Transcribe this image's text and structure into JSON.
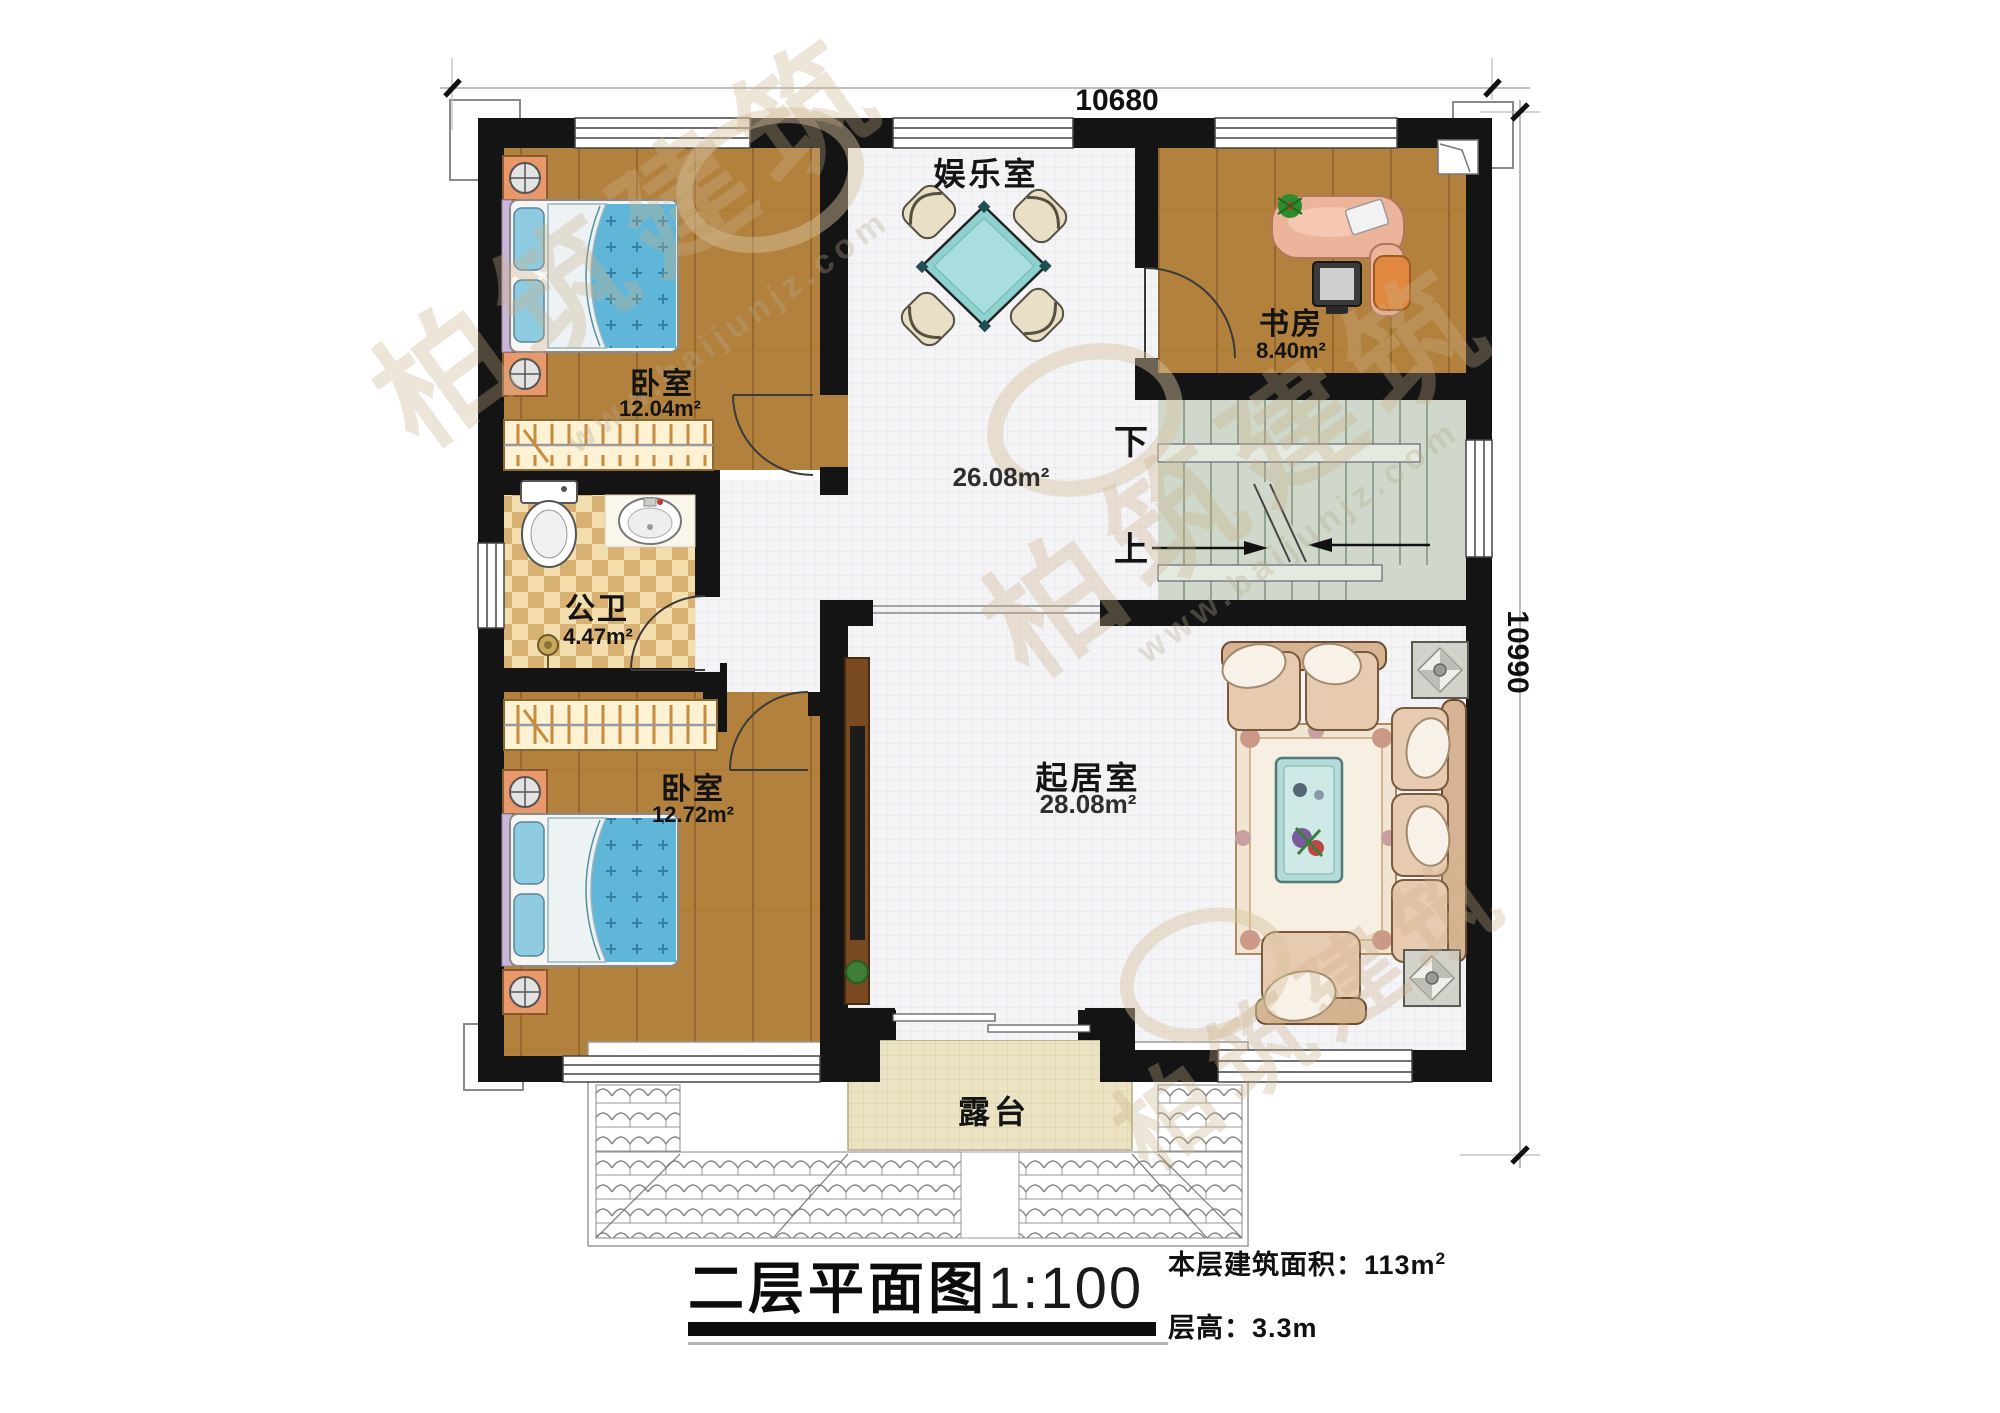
{
  "dimensions": {
    "top": "10680",
    "right": "10990"
  },
  "rooms": {
    "bedroom_top": {
      "name": "卧室",
      "area": "12.04m²"
    },
    "bathroom": {
      "name": "公卫",
      "area": "4.47m²"
    },
    "bedroom_bottom": {
      "name": "卧室",
      "area": "12.72m²"
    },
    "recreation": {
      "name": "娱乐室",
      "area": "26.08m²"
    },
    "study": {
      "name": "书房",
      "area": "8.40m²"
    },
    "living": {
      "name": "起居室",
      "area": "28.08m²"
    },
    "terrace": {
      "name": "露台"
    }
  },
  "stairs": {
    "down_label": "下",
    "up_label": "上"
  },
  "title_block": {
    "title": "二层平面图",
    "scale": "1:100",
    "area_label": "本层建筑面积：",
    "area_value": "113m",
    "area_sup": "2",
    "floor_height_label": "层高：",
    "floor_height_value": "3.3m"
  },
  "watermark": {
    "brand": "柏筑建筑",
    "url": "www.baijunjz.com"
  },
  "colors": {
    "wall": "#141414",
    "wood_floor": "#b2813e",
    "tile_floor": "#f4f4f6",
    "stair": "#cfd8ca",
    "bath_tile": "#eed9a4",
    "terrace": "#ebe3c3",
    "bed": "#5fb6d8",
    "sofa": "#ddbfa2",
    "game_table": "#8ed2d0",
    "desk": "#edb49c"
  }
}
